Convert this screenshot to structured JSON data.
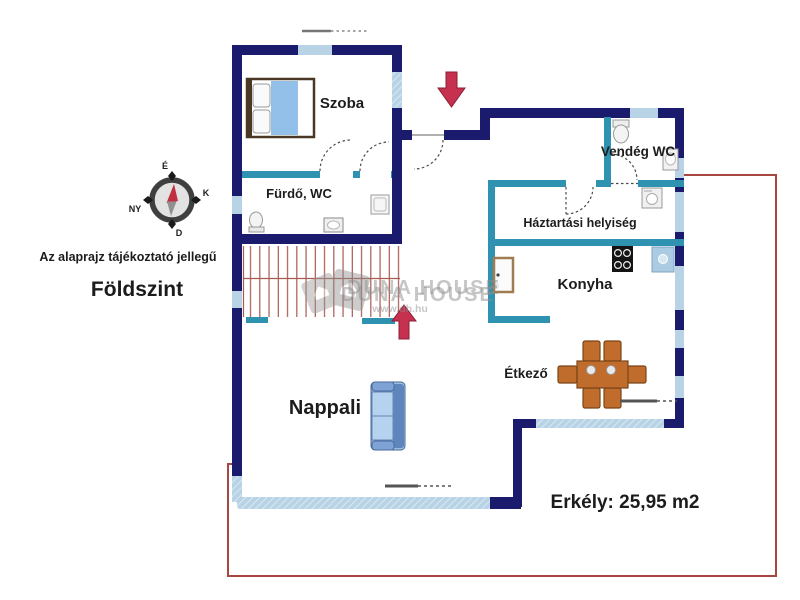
{
  "header": {
    "disclaimer": "Az alaprajz tájékoztató jellegű",
    "floor": "Földszint"
  },
  "compass": {
    "north": "É",
    "east": "K",
    "south": "D",
    "west": "NY"
  },
  "rooms": {
    "szoba": {
      "label": "Szoba"
    },
    "furdo_wc": {
      "label": "Fürdő, WC"
    },
    "vendeg_wc": {
      "label": "Vendég WC"
    },
    "haztartasi": {
      "label": "Háztartási helyiség"
    },
    "konyha": {
      "label": "Konyha"
    },
    "etkezo": {
      "label": "Étkező"
    },
    "nappali": {
      "label": "Nappali"
    }
  },
  "balcony": {
    "label": "Erkély: 25,95 m2"
  },
  "watermark": {
    "brand": "DUNA HOUSE",
    "reg": "®",
    "url": "www.dh.hu"
  },
  "icons": {
    "bed": "double-bed",
    "sofa": "sofa",
    "dining_table": "dining-table-6-chairs",
    "stove": "stove-4-burners",
    "kitchen_sink": "kitchen-sink",
    "fridge": "fridge",
    "washing_machine": "washing-machine",
    "toilet": "toilet",
    "washbasin": "washbasin",
    "shower": "shower-tray",
    "stairs": "staircase",
    "entrance_arrow": "arrow-down",
    "stairs_arrow": "arrow-up",
    "compass": "compass-rose"
  },
  "colors": {
    "wall_navy": "#1b1b6e",
    "wall_teal": "#2f92b0",
    "window_blue": "#b9d3e6",
    "stair_red": "#a85a50",
    "boundary_red": "#a8473f",
    "arrow_red": "#c5314e",
    "furniture_wood": "#c06c2c",
    "sofa_blue": "#9dbede",
    "label_dark": "#1c1c1c",
    "balcony_text": "#141452"
  }
}
